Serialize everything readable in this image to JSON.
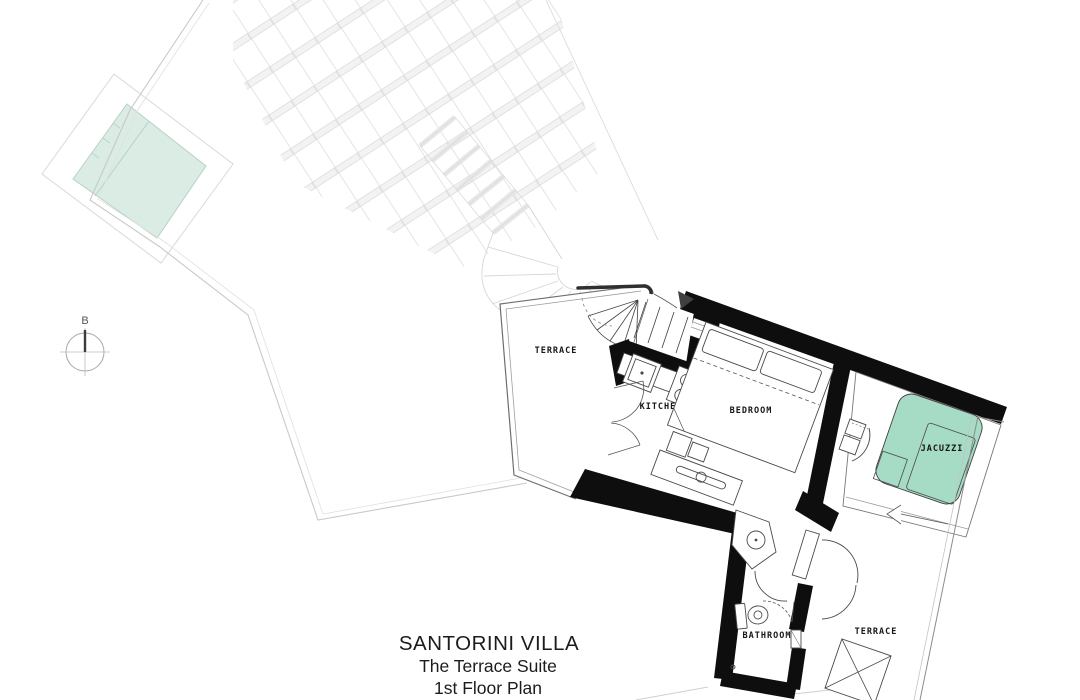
{
  "plan": {
    "title": {
      "line1": "SANTORINI VILLA",
      "line2": "The Terrace Suite",
      "line3": "1st Floor Plan"
    },
    "rooms": {
      "terrace_upper": "TERRACE",
      "kitchen": "KITCHEN",
      "bedroom": "BEDROOM",
      "jacuzzi": "JACUZZI",
      "bathroom": "BATHROOM",
      "terrace_lower": "TERRACE"
    },
    "section_marker": "B",
    "colors": {
      "pool": "#daece3",
      "jacuzzi": "#a6dbc5",
      "wall": "#0e0e0e"
    }
  }
}
